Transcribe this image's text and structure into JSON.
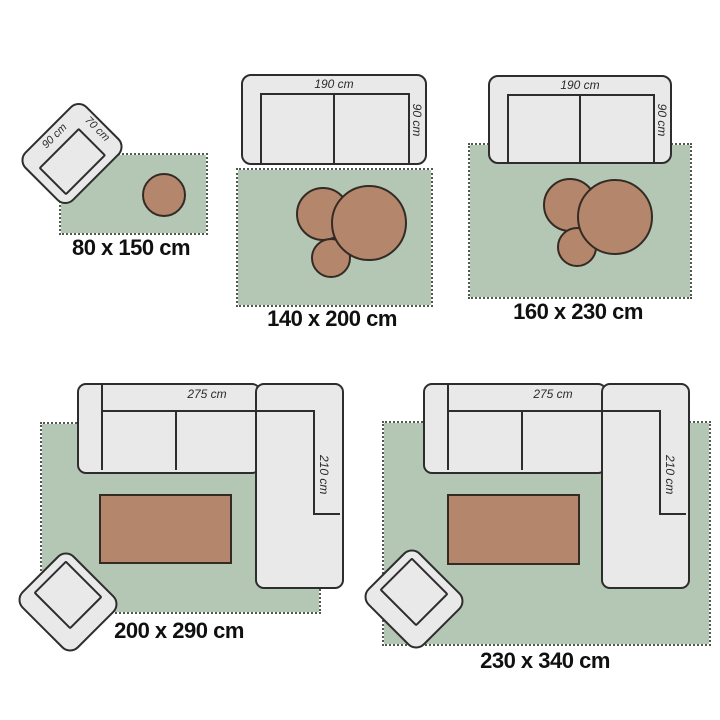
{
  "colors": {
    "rug_green": "#b3c7b4",
    "rug_fringe": "#4f584f",
    "furniture_fill": "#e9e9e9",
    "furniture_border": "#2d2d2d",
    "table_brown": "#b4866c",
    "table_border": "#332b24",
    "label_text": "#101010",
    "dimension_text": "#2b2b2b",
    "background": "#ffffff"
  },
  "scenes": [
    {
      "label": "80 x 150 cm",
      "furniture": {
        "armchair_width": "90 cm",
        "armchair_depth": "70 cm"
      }
    },
    {
      "label": "140 x 200 cm",
      "furniture": {
        "sofa_width": "190 cm",
        "sofa_depth": "90 cm"
      }
    },
    {
      "label": "160 x 230 cm",
      "furniture": {
        "sofa_width": "190 cm",
        "sofa_depth": "90 cm"
      }
    },
    {
      "label": "200 x 290 cm",
      "furniture": {
        "sofa_width": "275 cm",
        "sofa_depth": "210 cm"
      }
    },
    {
      "label": "230 x 340 cm",
      "furniture": {
        "sofa_width": "275 cm",
        "sofa_depth": "210 cm"
      }
    }
  ]
}
